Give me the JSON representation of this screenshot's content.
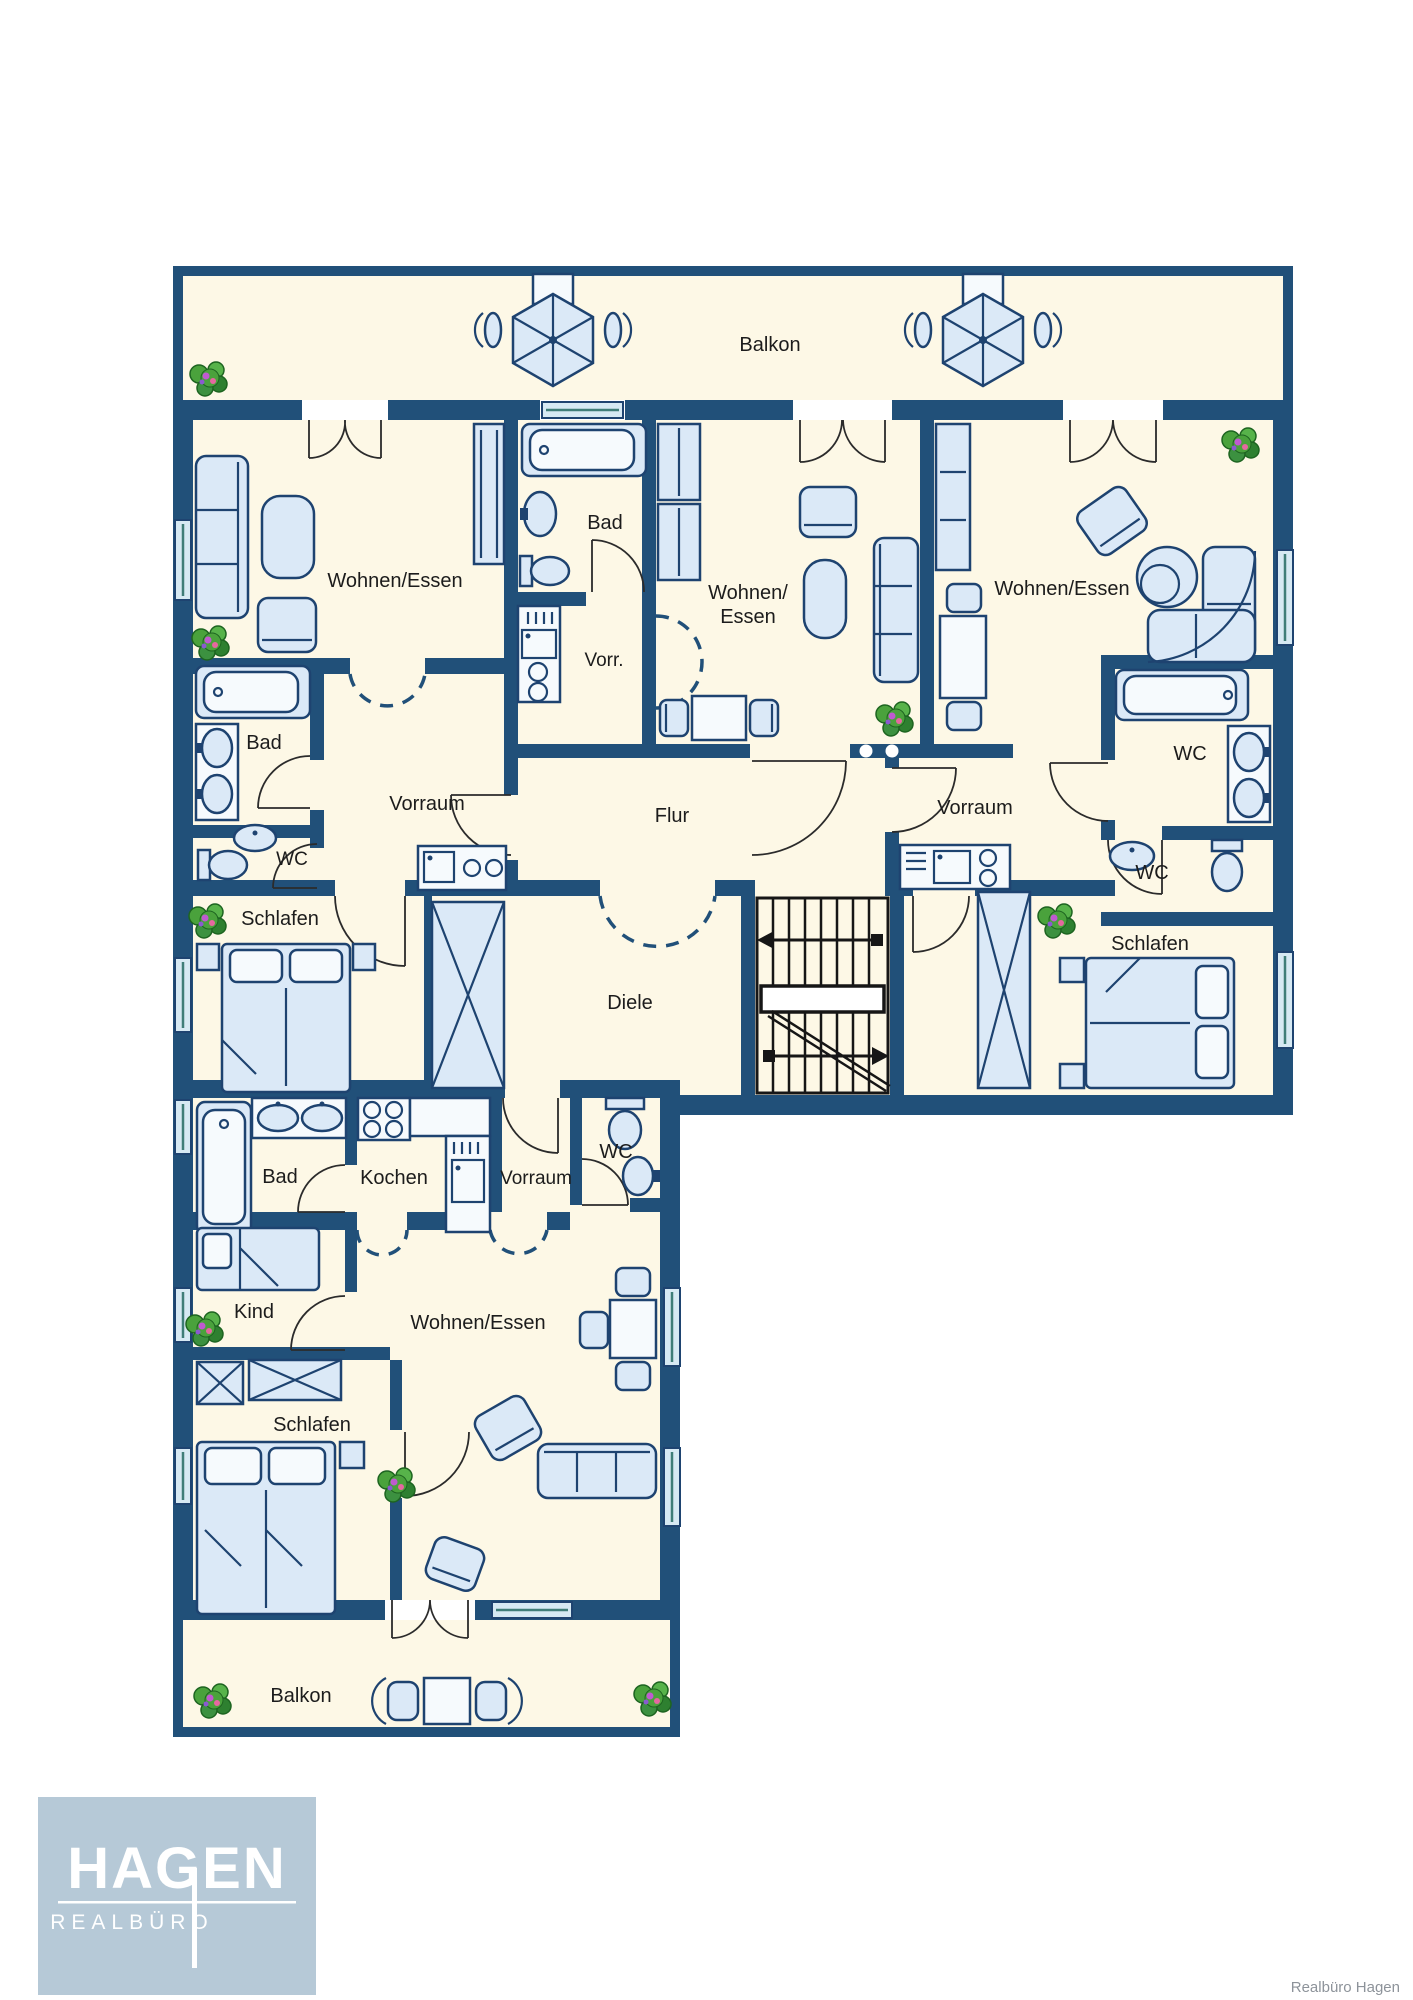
{
  "rooms": {
    "balkon_top": {
      "label": "Balkon"
    },
    "wohnen_essen_left": {
      "label": "Wohnen/Essen"
    },
    "bad_top": {
      "label": "Bad"
    },
    "wohnen_essen_mid_1": {
      "label": "Wohnen/"
    },
    "wohnen_essen_mid_2": {
      "label": "Essen"
    },
    "wohnen_essen_right": {
      "label": "Wohnen/Essen"
    },
    "vorr": {
      "label": "Vorr."
    },
    "bad_left": {
      "label": "Bad"
    },
    "vorraum_left": {
      "label": "Vorraum"
    },
    "wc_left": {
      "label": "WC"
    },
    "flur": {
      "label": "Flur"
    },
    "vorraum_right": {
      "label": "Vorraum"
    },
    "wc_right_upper": {
      "label": "WC"
    },
    "wc_right_lower": {
      "label": "WC"
    },
    "schlafen_left": {
      "label": "Schlafen"
    },
    "schlafen_right": {
      "label": "Schlafen"
    },
    "diele": {
      "label": "Diele"
    },
    "bad_lower": {
      "label": "Bad"
    },
    "kochen": {
      "label": "Kochen"
    },
    "vorraum_lower": {
      "label": "Vorraum"
    },
    "wc_lower": {
      "label": "WC"
    },
    "kind": {
      "label": "Kind"
    },
    "wohnen_essen_lower": {
      "label": "Wohnen/Essen"
    },
    "schlafen_lower": {
      "label": "Schlafen"
    },
    "balkon_bottom": {
      "label": "Balkon"
    }
  },
  "logo": {
    "name": "HAGEN",
    "subtitle": "REALBÜRO"
  },
  "footer": {
    "credit": "Realbüro Hagen"
  },
  "icons": {
    "plant-icon": "potted plant",
    "parasol-icon": "patio umbrella",
    "stairs-icon": "staircase with up/down arrows",
    "bathtub-icon": "bathtub",
    "toilet-icon": "toilet",
    "sink-icon": "wash basin",
    "stove-icon": "cooktop with burners",
    "bed-icon": "bed",
    "sofa-icon": "sofa",
    "wardrobe-icon": "wardrobe"
  },
  "colors": {
    "wall": "#215079",
    "floor": "#fdf8e6",
    "furniture_fill": "#dbe9f7",
    "furniture_stroke": "#1e4370",
    "stairs": "#161616",
    "plant": "#4aa23c",
    "logo_bg": "#b6c9d7",
    "logo_text": "#ffffff",
    "credit_text": "#8d939a"
  }
}
